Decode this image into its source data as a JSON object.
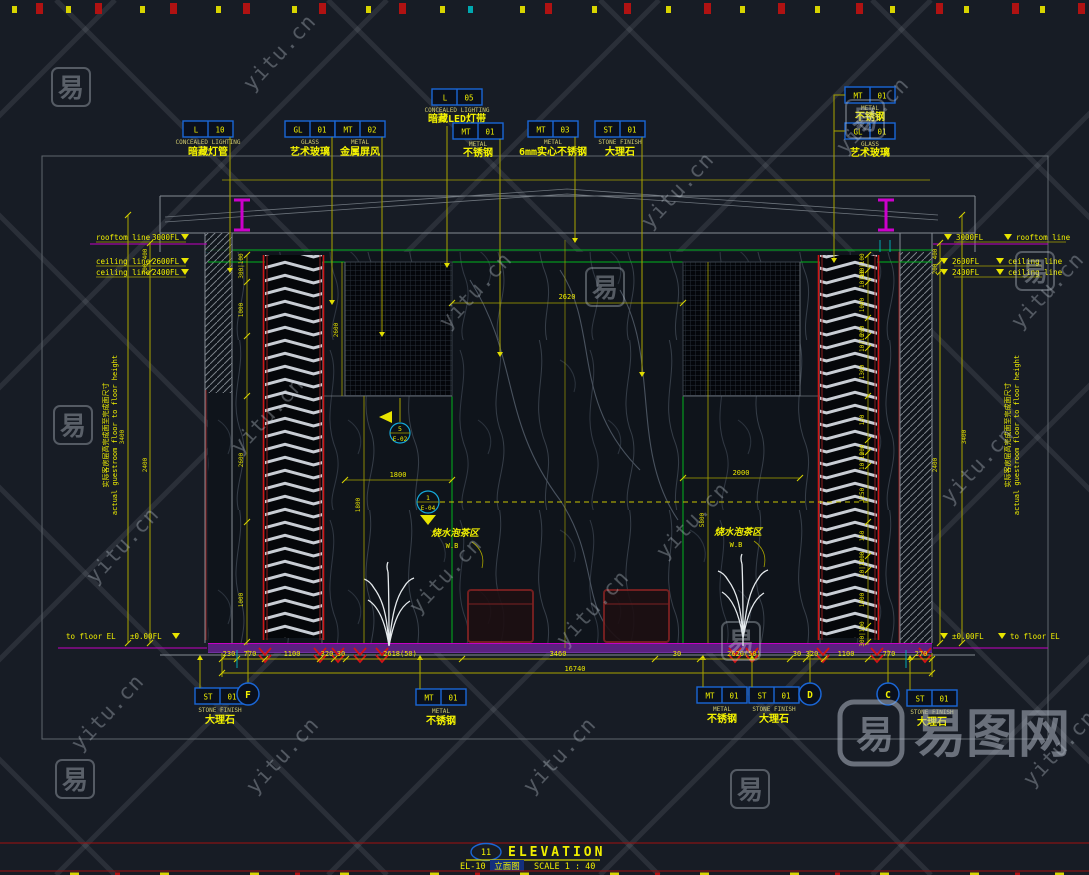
{
  "watermark": {
    "site": "yitu.cn",
    "char": "易",
    "logo": "易图网"
  },
  "titleblock": {
    "bubble": "11",
    "title": "ELEVATION",
    "code": "EL-10",
    "name_cn": "立面图",
    "scale": "SCALE 1 : 40"
  },
  "callouts": {
    "top": [
      {
        "tag": "L",
        "num": "10",
        "type": "CONCEALED LIGHTING",
        "label": "暗藏灯管"
      },
      {
        "tag": "GL",
        "num": "01",
        "type": "GLASS",
        "label": "艺术玻璃"
      },
      {
        "tag": "MT",
        "num": "02",
        "type": "METAL",
        "label": "金属屏风"
      },
      {
        "tag": "L",
        "num": "05",
        "type": "CONCEALED LIGHTING",
        "label": "暗藏LED灯带"
      },
      {
        "tag": "MT",
        "num": "01",
        "type": "METAL",
        "label": "不锈钢"
      },
      {
        "tag": "MT",
        "num": "03",
        "type": "METAL",
        "label": "6mm实心不锈钢"
      },
      {
        "tag": "ST",
        "num": "01",
        "type": "STONE FINISH",
        "label": "大理石"
      },
      {
        "tag": "MT",
        "num": "01",
        "type": "METAL",
        "label": "不锈钢"
      },
      {
        "tag": "GL",
        "num": "01",
        "type": "GLASS",
        "label": "艺术玻璃"
      }
    ],
    "bottom": [
      {
        "tag": "ST",
        "num": "01",
        "type": "STONE FINISH",
        "label": "大理石"
      },
      {
        "tag": "MT",
        "num": "01",
        "type": "METAL",
        "label": "不锈钢"
      },
      {
        "tag": "MT",
        "num": "01",
        "type": "METAL",
        "label": "不锈钢"
      },
      {
        "tag": "ST",
        "num": "01",
        "type": "STONE FINISH",
        "label": "大理石"
      },
      {
        "tag": "ST",
        "num": "01",
        "type": "STONE FINISH",
        "label": "大理石"
      }
    ]
  },
  "levels": {
    "left": [
      {
        "label": "rooftom line",
        "value": "3000FL"
      },
      {
        "label": "ceiling line",
        "value": "2600FL"
      },
      {
        "label": "ceiling line",
        "value": "2400FL"
      },
      {
        "label": "to floor EL",
        "value": "±0.00FL"
      }
    ],
    "right": [
      {
        "value": "3000FL",
        "label": "rooftom line"
      },
      {
        "value": "2600FL",
        "label": "ceiling line"
      },
      {
        "value": "2400FL",
        "label": "ceiling line"
      },
      {
        "value": "±0.00FL",
        "label": "to floor EL"
      }
    ]
  },
  "grid": {
    "bubbles": [
      "F",
      "D",
      "C"
    ]
  },
  "zones": [
    {
      "name": "烧水泡茶区",
      "code": "W.B"
    },
    {
      "name": "烧水泡茶区",
      "code": "W.B"
    }
  ],
  "markers": [
    {
      "num": "5",
      "sheet": "E-02"
    },
    {
      "num": "1",
      "sheet": "E-04"
    }
  ],
  "side_note": {
    "cn": "实际客房层高完成面至完成面尺寸",
    "en": "actual guestroom floor to floor height"
  },
  "dims": {
    "bottom": [
      "230",
      "770",
      "1100",
      "320",
      "30",
      "2618(50)",
      "3460",
      "30",
      "2620(50)",
      "30",
      "320",
      "1100",
      "770",
      "270"
    ],
    "bottom_total": "16740",
    "top_gaps": [
      "400",
      "200"
    ],
    "floor_to_floor": "3400",
    "ceiling_height": "2400",
    "right_inner": [
      "300|100",
      "10|10",
      "1000",
      "200",
      "10|10",
      "1300",
      "150",
      "200",
      "10|10",
      "1250",
      "150",
      "200",
      "10|10",
      "1000",
      "300|100"
    ],
    "left_inner": [
      "300|100",
      "1000",
      "2600",
      "1000"
    ],
    "horizontal": [
      "2620",
      "1800",
      "2000"
    ],
    "vertical": [
      "2600",
      "1800",
      "5800"
    ]
  }
}
